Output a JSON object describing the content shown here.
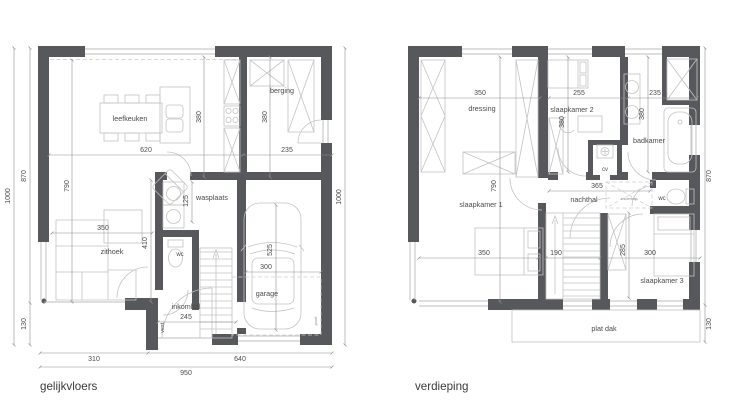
{
  "ground_floor": {
    "title": "gelijkvloers",
    "rooms": {
      "leefkeuken": "leefkeuken",
      "berging": "berging",
      "wasplaats": "wasplaats",
      "zithoek": "zithoek",
      "wc": "wc",
      "vest": "vest.",
      "inkomhal": "inkomhal",
      "garage": "garage",
      "garage_door_note": "poort"
    },
    "dims": {
      "kitchen_w": "620",
      "berging_w": "235",
      "kitchen_d": "380",
      "berging_d": "380",
      "living_d": "790",
      "zithoek_w": "350",
      "wasplaats_w": "125",
      "hall_d": "410",
      "inkomhal_w": "245",
      "garage_l": "525",
      "garage_w": "300",
      "side_main": "870",
      "side_step": "130",
      "side_total": "1000",
      "right_total": "1000",
      "front_left": "310",
      "front_garage": "640",
      "front_total": "950"
    }
  },
  "upper_floor": {
    "title": "verdieping",
    "rooms": {
      "dressing": "dressing",
      "slaapkamer_1": "slaapkamer 1",
      "slaapkamer_2": "slaapkamer 2",
      "slaapkamer_3": "slaapkamer 3",
      "badkamer": "badkamer",
      "nachthal": "nachthal",
      "wc": "wc",
      "cv": "cv",
      "zoldertrap": "zoldertrap",
      "plat_dak": "plat dak"
    },
    "dims": {
      "dressing_w": "350",
      "sk2_w": "255",
      "bad_w": "235",
      "sk2_d": "380",
      "bad_d": "380",
      "sk1_d": "790",
      "nachthal_w": "365",
      "sk1_w": "350",
      "stair_w": "190",
      "sk3_d": "285",
      "sk3_w": "300",
      "side_main": "870",
      "side_roof": "130"
    }
  }
}
